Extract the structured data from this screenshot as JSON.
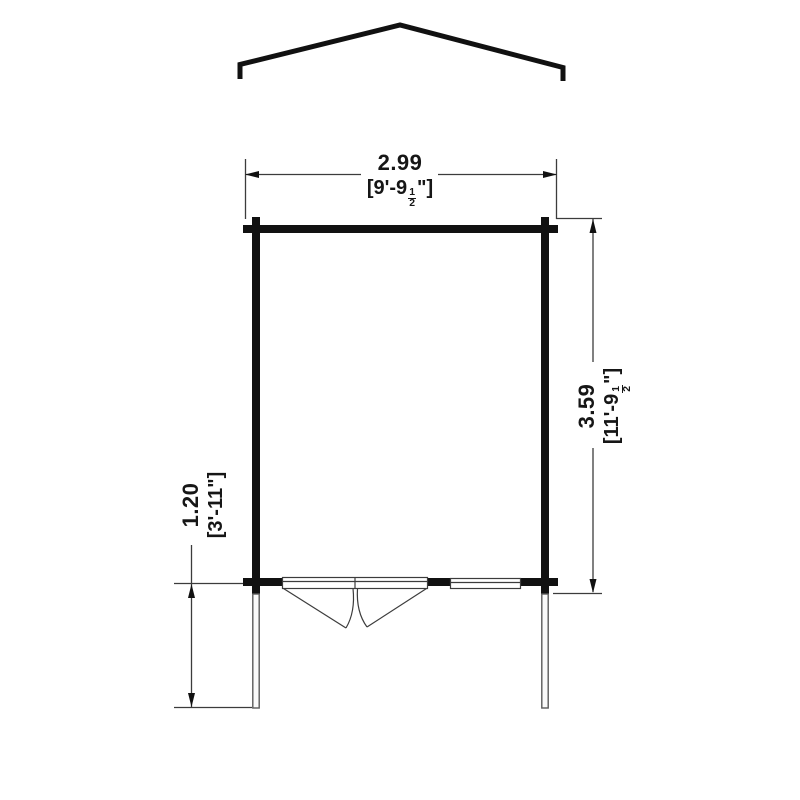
{
  "drawing": {
    "type": "log-cabin-floor-plan",
    "colors": {
      "wall_line": "#111111",
      "thin_line": "#3c3c3c",
      "background": "#ffffff"
    },
    "dimensions": {
      "width": {
        "metric": "2.99",
        "imperial_prefix": "[9'-9",
        "fraction_numerator": "1",
        "fraction_denominator": "2",
        "imperial_suffix": "\"]"
      },
      "depth": {
        "metric": "3.59",
        "imperial_prefix": "[11'-9",
        "fraction_numerator": "1",
        "fraction_denominator": "2",
        "imperial_suffix": "\"]"
      },
      "overhang": {
        "metric": "1.20",
        "imperial": "[3'-11\"]"
      }
    }
  }
}
